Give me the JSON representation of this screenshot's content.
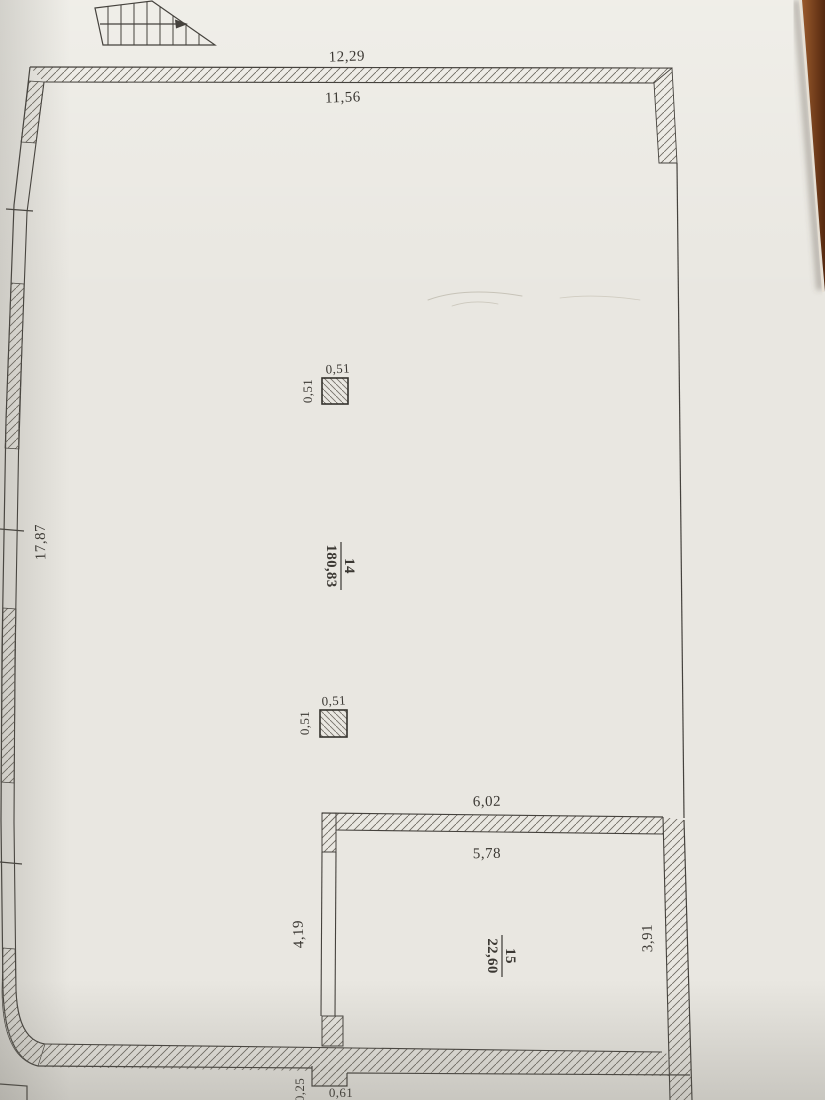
{
  "plan": {
    "rooms": [
      {
        "number": "14",
        "area": "180,83"
      },
      {
        "number": "15",
        "area": "22,60"
      }
    ],
    "dims": {
      "top_outer": "12,29",
      "top_inner": "11,56",
      "left_height": "17,87",
      "partition_top": "6,02",
      "room15_width": "5,78",
      "room15_left_height": "4,19",
      "room15_right_height": "3,91",
      "pier_offset": "0,25",
      "pier_width": "0,61"
    },
    "columns": [
      {
        "top": "0,51",
        "side": "0,51"
      },
      {
        "top": "0,51",
        "side": "0,51"
      }
    ],
    "colors": {
      "paper": "#e9e7e1",
      "ink": "#3b3833",
      "line": "#45423d",
      "hatch": "#6f6b62",
      "wood_light": "#9a5a2c",
      "wood_dark": "#54280f"
    }
  }
}
